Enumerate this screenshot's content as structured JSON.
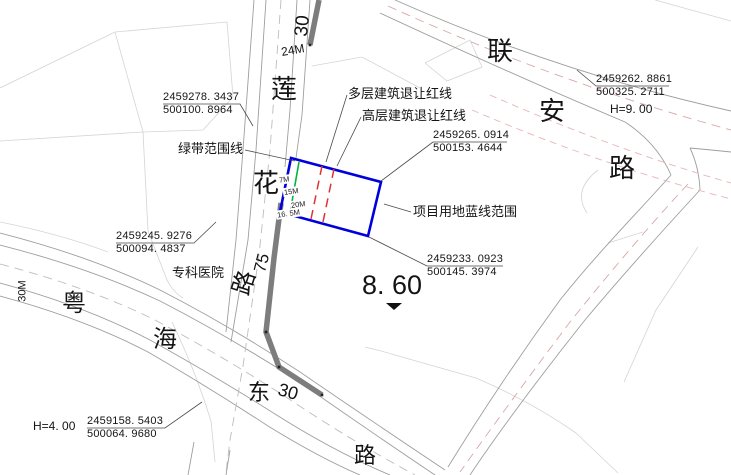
{
  "colors": {
    "site_boundary_blue": "#0000dd",
    "green_belt_green": "#00b43c",
    "setback_red": "#e03232",
    "road_emphasis_gray": "#7d7d7d"
  },
  "roads": {
    "lianhua": {
      "chars": [
        "莲",
        "花",
        "路"
      ],
      "number": "75",
      "top_number": "30",
      "width_dim": "24M"
    },
    "lianan": {
      "chars": [
        "联",
        "安",
        "路"
      ]
    },
    "yuehai": {
      "chars": [
        "粤",
        "海",
        "东",
        "路"
      ],
      "number": "30",
      "width_dim": "30M"
    }
  },
  "site": {
    "blue_line_label": "项目用地蓝线范围",
    "green_belt_label": "绿带范围线",
    "multi_storey_setback_label": "多层建筑退让红线",
    "highrise_setback_label": "高层建筑退让红线",
    "setback_dims": [
      "7M",
      "15M",
      "20M",
      "16. 5M"
    ]
  },
  "landmarks": {
    "hospital": "专科医院"
  },
  "coordinates": [
    {
      "n": "2459278. 3437",
      "e": "500100. 8964"
    },
    {
      "n": "2459265. 0914",
      "e": "500153. 4644"
    },
    {
      "n": "2459262. 8861",
      "e": "500325. 2711"
    },
    {
      "n": "2459245. 9276",
      "e": "500094. 4837"
    },
    {
      "n": "2459233. 0923",
      "e": "500145. 3974"
    },
    {
      "n": "2459158. 5403",
      "e": "500064. 9680"
    }
  ],
  "elevations": {
    "spot": "8. 60",
    "h_north": "H=9. 00",
    "h_south": "H=4. 00"
  }
}
